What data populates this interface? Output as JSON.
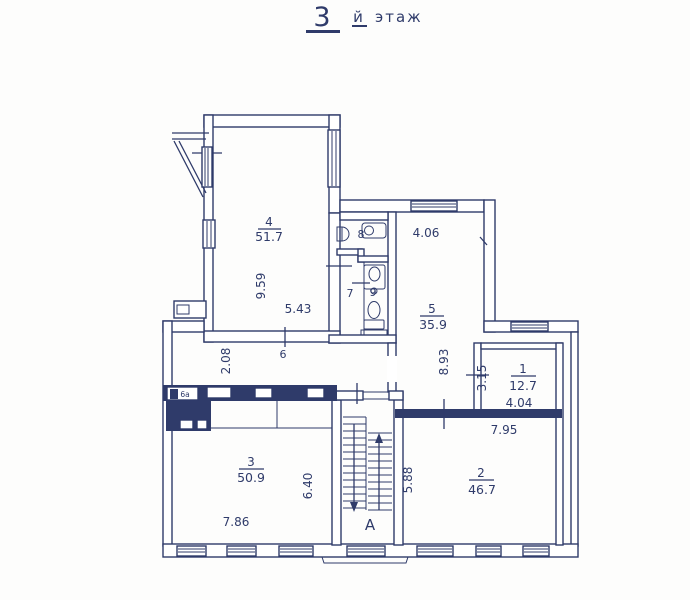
{
  "colors": {
    "ink": "#2f3b6a",
    "paper": "#fdfdfc"
  },
  "title": {
    "floor_number": "3",
    "floor_suffix": "й",
    "floor_word": "этаж"
  },
  "rooms": {
    "r1": {
      "number": "1",
      "area": "12.7",
      "width": "4.04",
      "height": "3.15"
    },
    "r2": {
      "number": "2",
      "area": "46.7",
      "width": "7.95",
      "height": "5.88"
    },
    "r3": {
      "number": "3",
      "area": "50.9",
      "width": "7.86",
      "height": "6.40"
    },
    "r4": {
      "number": "4",
      "area": "51.7",
      "width": "5.43",
      "height": "9.59"
    },
    "r5": {
      "number": "5",
      "area": "35.9",
      "width": "4.06",
      "height": "8.93"
    },
    "r6": {
      "number": "6",
      "height": "2.08"
    },
    "r6a": {
      "number": "6а"
    },
    "r7": {
      "number": "7"
    },
    "r8": {
      "number": "8"
    },
    "r9": {
      "number": "9"
    }
  },
  "stairwell": {
    "letter": "А"
  }
}
